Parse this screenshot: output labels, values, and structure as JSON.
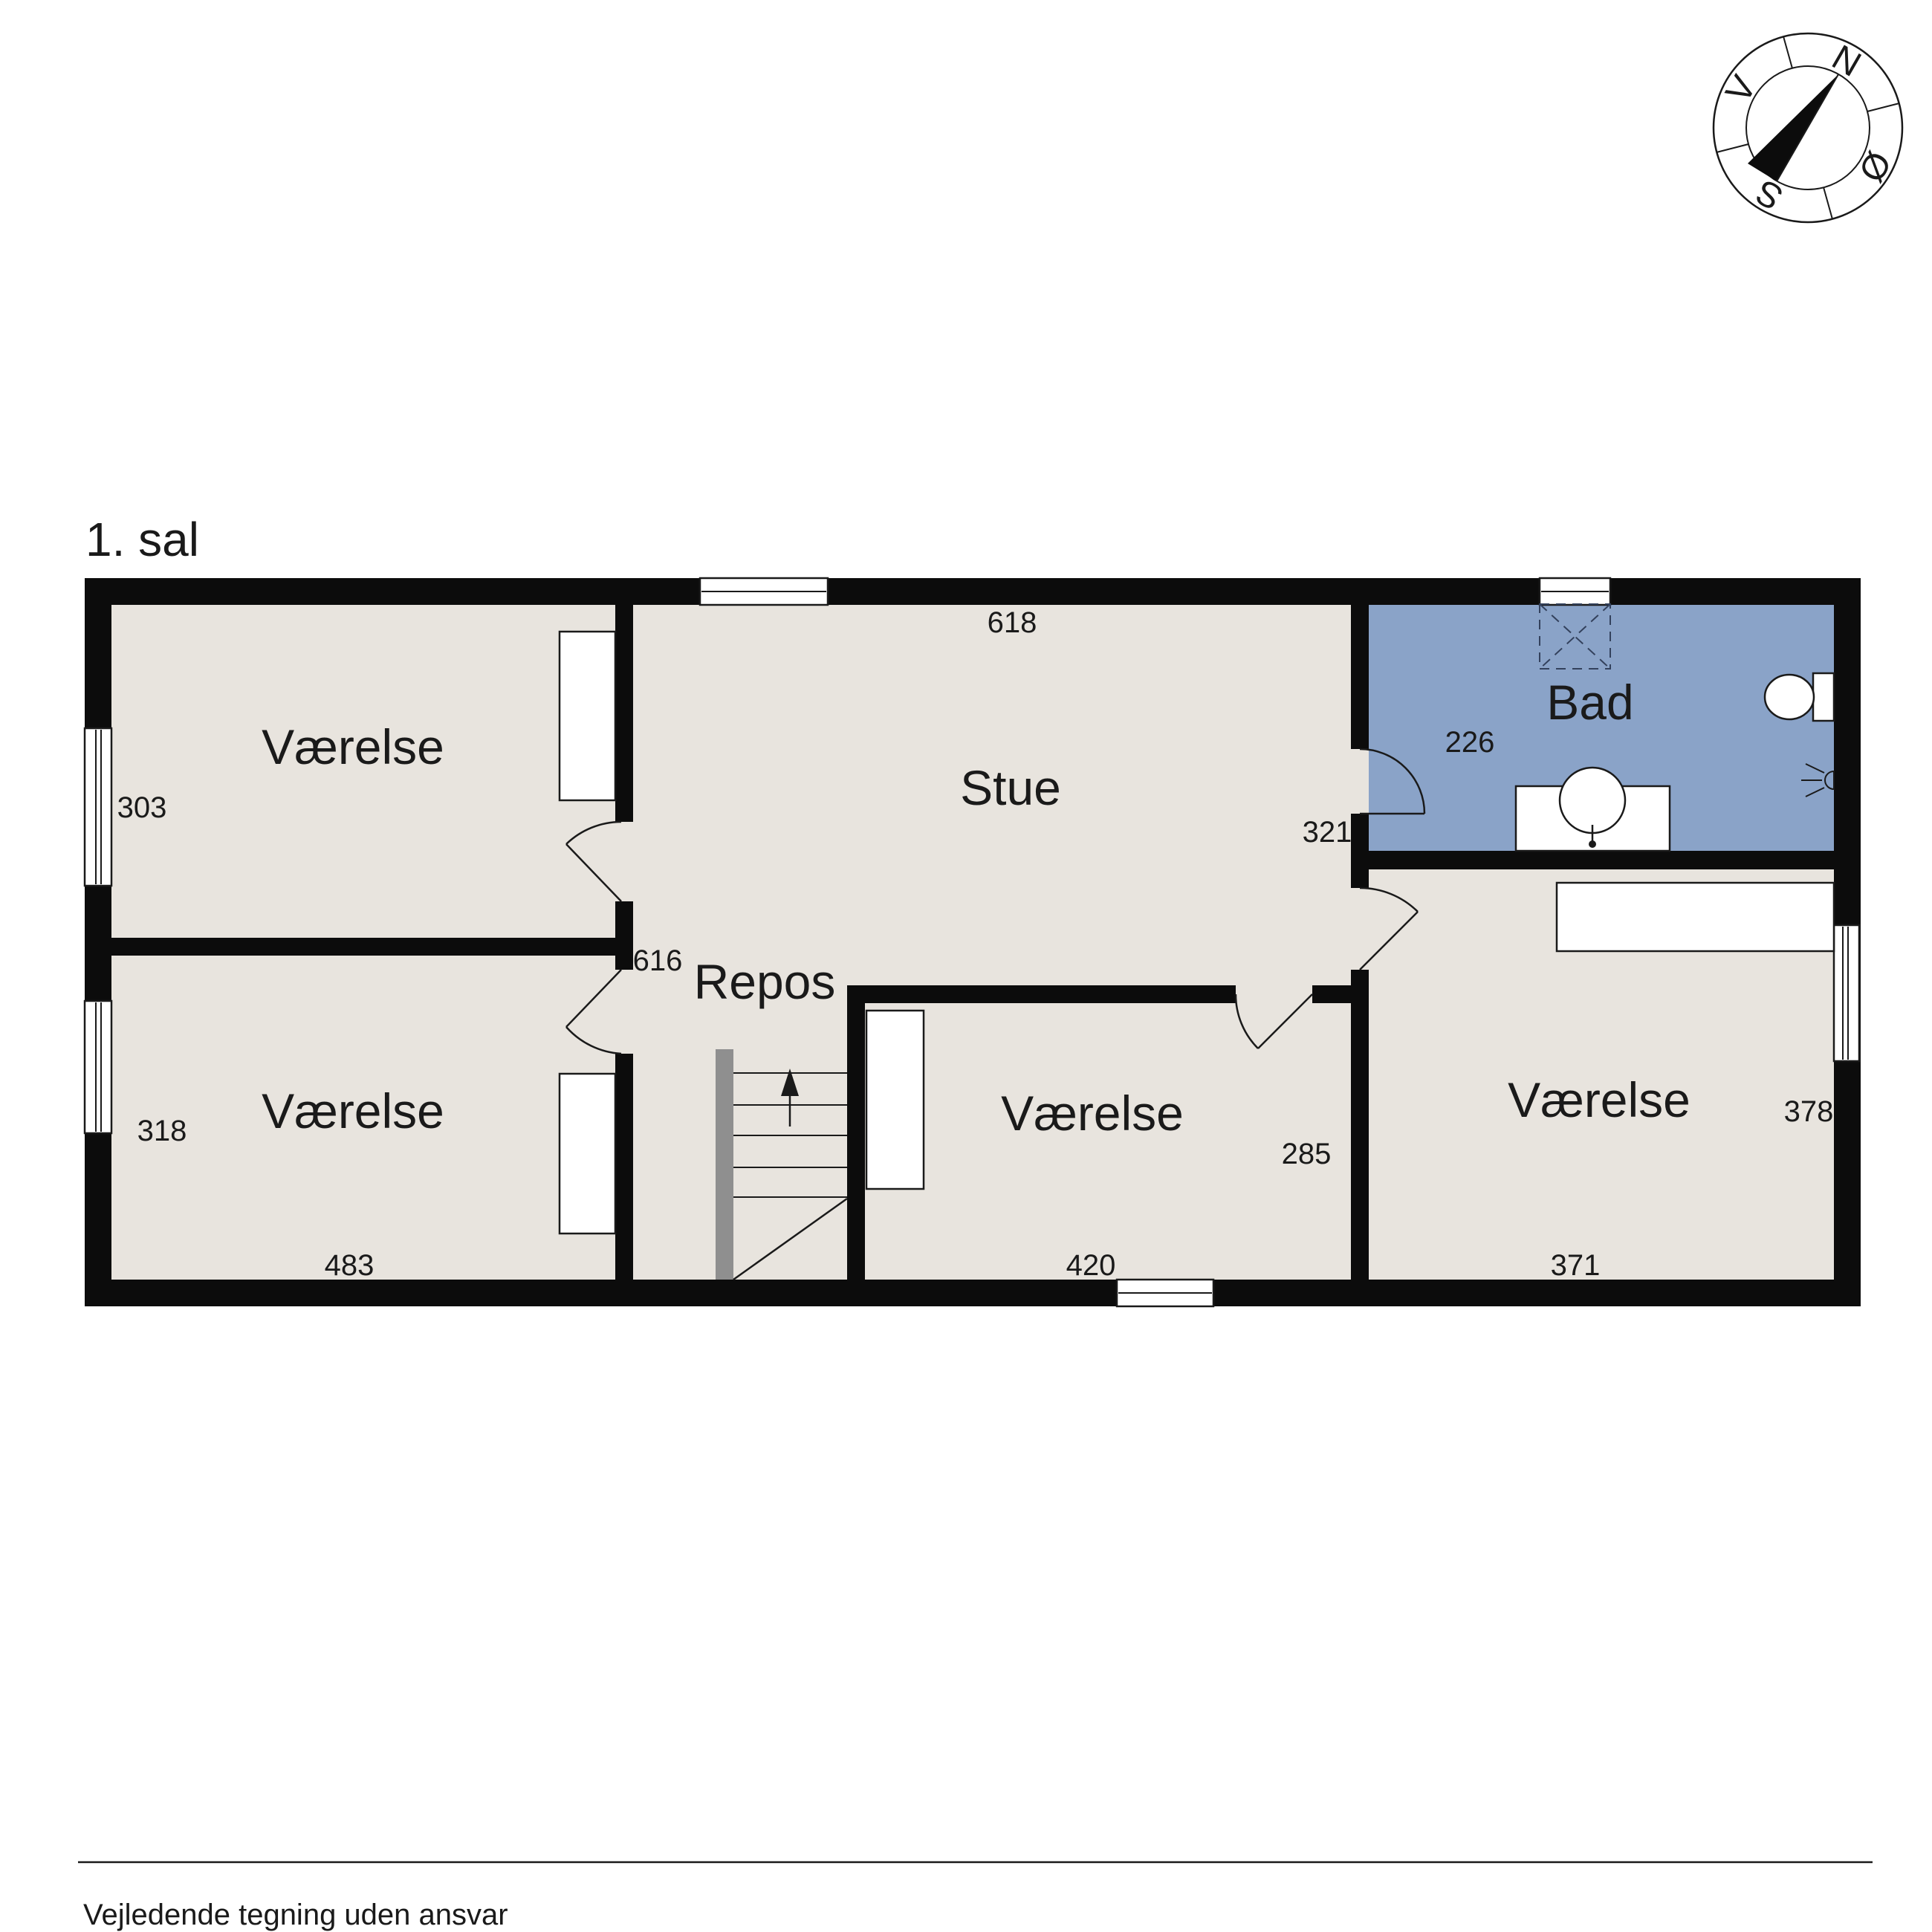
{
  "title": "1. sal",
  "footer": "Vejledende tegning uden ansvar",
  "colors": {
    "floor": "#e8e4de",
    "bathroom": "#8aa3c8",
    "wall": "#0c0c0c",
    "stair_rail": "#8f8f8f"
  },
  "compass": {
    "north": "N",
    "east": "Ø",
    "south": "S",
    "west": "V"
  },
  "rooms": {
    "bedroom_nw": {
      "label": "Værelse",
      "dim_height": "303"
    },
    "bedroom_sw": {
      "label": "Værelse",
      "dim_height": "318",
      "dim_width": "483"
    },
    "living": {
      "label": "Stue",
      "dim_width": "618",
      "dim_right": "321"
    },
    "landing": {
      "label": "Repos",
      "dim_width": "616"
    },
    "bath": {
      "label": "Bad",
      "dim_height": "226"
    },
    "bedroom_s": {
      "label": "Værelse",
      "dim_height": "285",
      "dim_width": "420"
    },
    "bedroom_se": {
      "label": "Værelse",
      "dim_height": "378",
      "dim_width": "371"
    }
  }
}
